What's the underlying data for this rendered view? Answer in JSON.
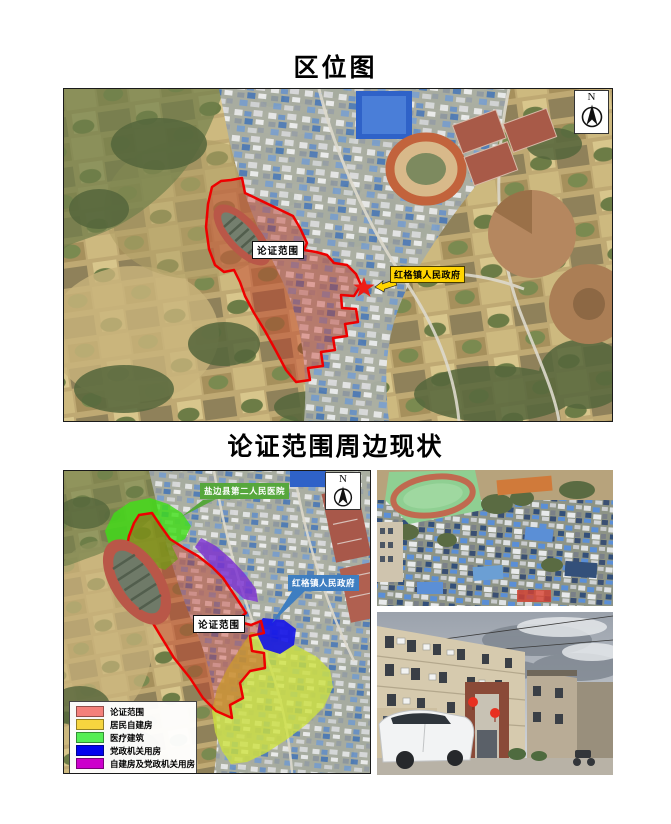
{
  "document": {
    "section1": {
      "title": "区位图",
      "map": {
        "compass": "N",
        "scope_label": "论证范围",
        "gov_callout": "红格镇人民政府",
        "scope_outline_color": "#ee0000",
        "gov_callout_bg": "#ffd400"
      }
    },
    "section2": {
      "title": "论证范围周边现状",
      "map": {
        "compass": "N",
        "scope_label": "论证范围",
        "hospital_callout": "盐边县第二人民医院",
        "gov_callout": "红格镇人民政府",
        "hospital_callout_bg": "#56a73c",
        "gov_callout_bg": "#3e7ec1",
        "scope_outline_color": "#ee0000"
      },
      "legend": {
        "items": [
          {
            "label": "论证范围",
            "color": "#f4817b"
          },
          {
            "label": "居民自建房",
            "color": "#f6d53f"
          },
          {
            "label": "医疗建筑",
            "color": "#55ee55"
          },
          {
            "label": "党政机关用房",
            "color": "#0202ee"
          },
          {
            "label": "自建房及党政机关用房",
            "color": "#cc00cc"
          }
        ]
      }
    }
  }
}
